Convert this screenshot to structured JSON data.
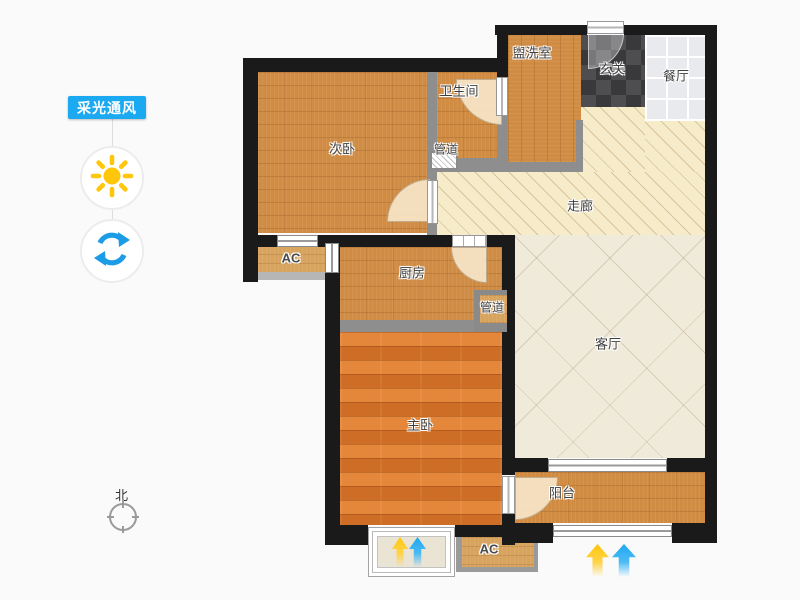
{
  "sidebar": {
    "tool_button_label": "采光通风",
    "icons": [
      "sun-icon",
      "rotate-icon"
    ]
  },
  "compass": {
    "north_label": "北"
  },
  "legend_arrows": {
    "daylight_color": "#FFC60B",
    "airflow_color": "#1FA7F0"
  },
  "floorplan": {
    "rooms": [
      {
        "id": "bedroom2",
        "label": "次卧"
      },
      {
        "id": "bathroom",
        "label": "卫生间"
      },
      {
        "id": "washroom",
        "label": "盥洗室"
      },
      {
        "id": "entry",
        "label": "玄关"
      },
      {
        "id": "dining",
        "label": "餐厅"
      },
      {
        "id": "corridor",
        "label": "走廊"
      },
      {
        "id": "kitchen",
        "label": "厨房"
      },
      {
        "id": "living",
        "label": "客厅"
      },
      {
        "id": "master",
        "label": "主卧"
      },
      {
        "id": "balcony",
        "label": "阳台"
      },
      {
        "id": "ac_mid",
        "label": "AC"
      },
      {
        "id": "ac_bottom",
        "label": "AC"
      },
      {
        "id": "duct_top",
        "label": "管道"
      },
      {
        "id": "duct_kitchen",
        "label": "管道"
      }
    ],
    "colors": {
      "wall_dark": "#1A1A1A",
      "wall_light": "#8E8E8E",
      "wood_floor": "#D18C44",
      "master_wood_floor": "#DC792E",
      "corridor_floor": "#F7ECCA",
      "living_floor": "#F0EADA",
      "dining_tile": "#E9EAED",
      "entry_tile": "#3A3A3C",
      "accent_blue": "#1BAAF2",
      "sun_yellow": "#FFC60B",
      "refresh_blue": "#1C9BE6"
    }
  }
}
